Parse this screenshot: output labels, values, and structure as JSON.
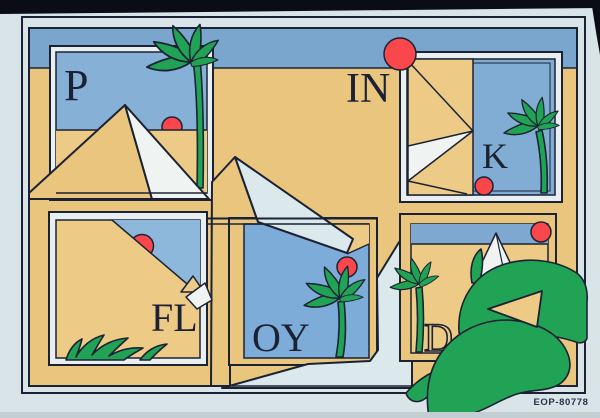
{
  "letters": {
    "p": "P",
    "in": "IN",
    "k": "K",
    "fl": "FL",
    "oy": "OY",
    "d": "D"
  },
  "catalog_number": "EOP-80778",
  "colors": {
    "margin": "#d9e4e8",
    "ink": "#1b2234",
    "tan": "#eac57e",
    "tan2": "#edcb86",
    "sky": "#7aa6cd",
    "skyP": "#86b0d6",
    "skyK": "#81acd3",
    "skyFL": "#8eb8db",
    "skyOY": "#7eacd8",
    "skyD": "#7ea8d0",
    "white1": "#eff4f3",
    "white2": "#dbe9ec",
    "green": "#21a355",
    "sun": "#f9474c",
    "frameGap": "#e9eff1",
    "photoEdge": "#0a0d16",
    "bottomEdge": "#c2ced2",
    "label": "#2a3147"
  }
}
